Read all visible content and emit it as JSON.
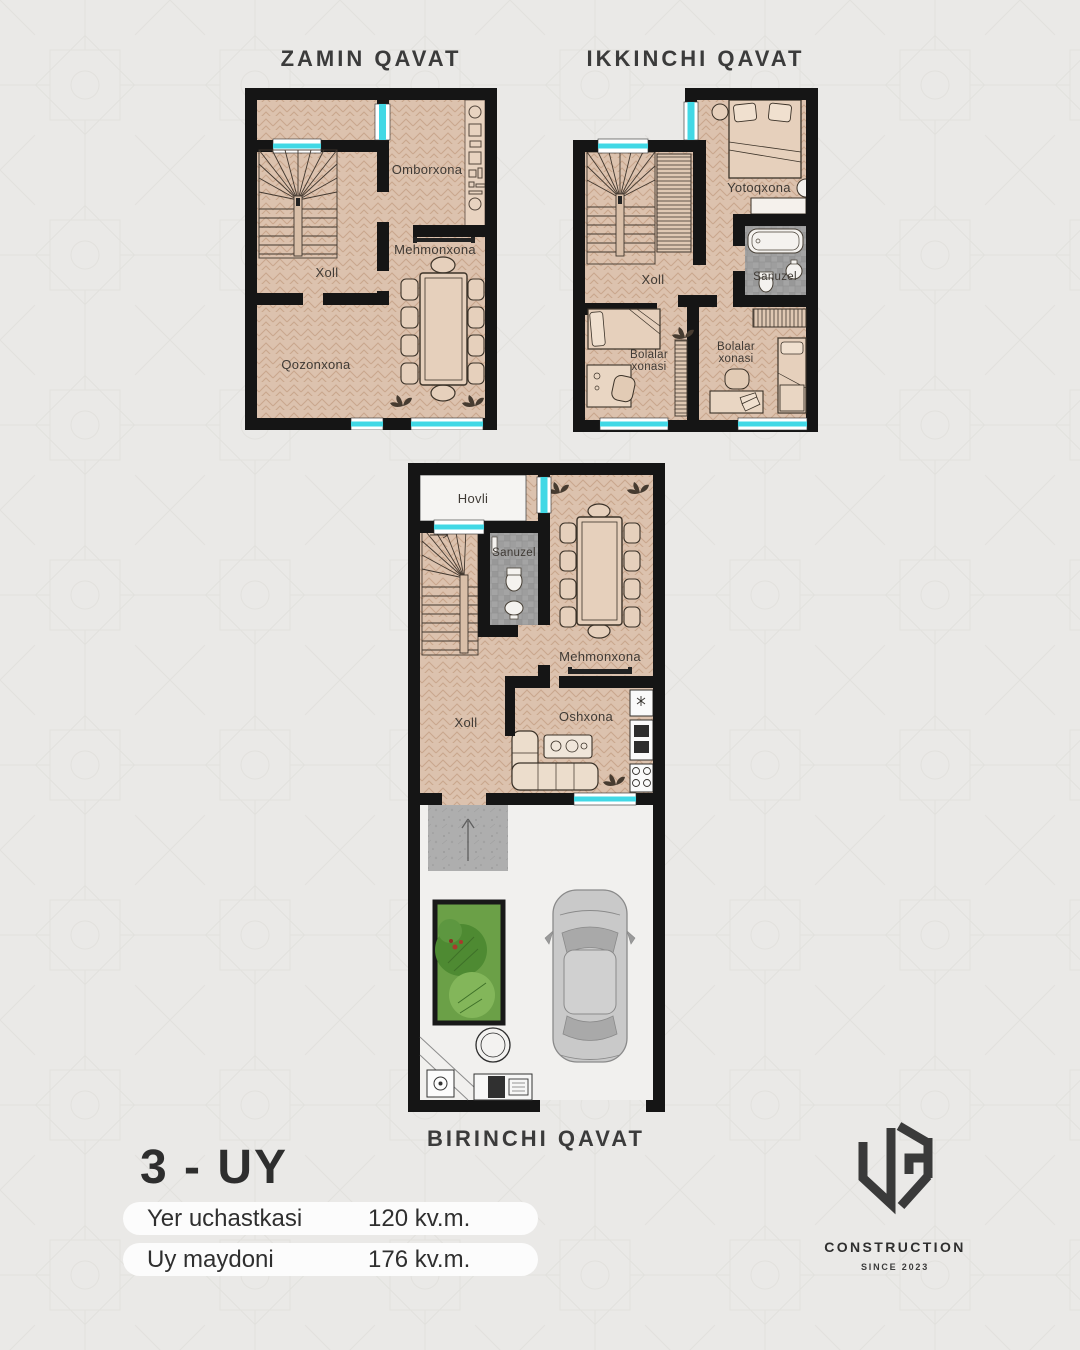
{
  "colors": {
    "background": "#eae9e7",
    "wall": "#151515",
    "floor": "#dcc2ae",
    "window": "#41d8e5",
    "tile": "#a4a4a4",
    "garden_green": "#6ba047",
    "text": "#3b3b3b"
  },
  "plans": {
    "zamin": {
      "title": "ZAMIN QAVAT",
      "labels": {
        "omborxona": "Omborxona",
        "mehmonxona": "Mehmonxona",
        "xoll": "Xoll",
        "qozonxona": "Qozonxona"
      }
    },
    "ikkinchi": {
      "title": "IKKINCHI QAVAT",
      "labels": {
        "yotoqxona": "Yotoqxona",
        "sanuzel": "Sanuzel",
        "xoll": "Xoll",
        "bolalar_line1": "Bolalar",
        "bolalar_line2": "xonasi"
      }
    },
    "birinchi": {
      "title": "BIRINCHI QAVAT",
      "labels": {
        "hovli": "Hovli",
        "sanuzel": "Sanuzel",
        "mehmonxona": "Mehmonxona",
        "xoll": "Xoll",
        "oshxona": "Oshxona"
      }
    }
  },
  "info": {
    "house_title": "3 - UY",
    "rows": [
      {
        "label": "Yer uchastkasi",
        "value": "120 kv.m."
      },
      {
        "label": "Uy maydoni",
        "value": "176 kv.m."
      }
    ]
  },
  "logo": {
    "monogram": "UG",
    "name": "CONSTRUCTION",
    "since": "SINCE 2023"
  }
}
